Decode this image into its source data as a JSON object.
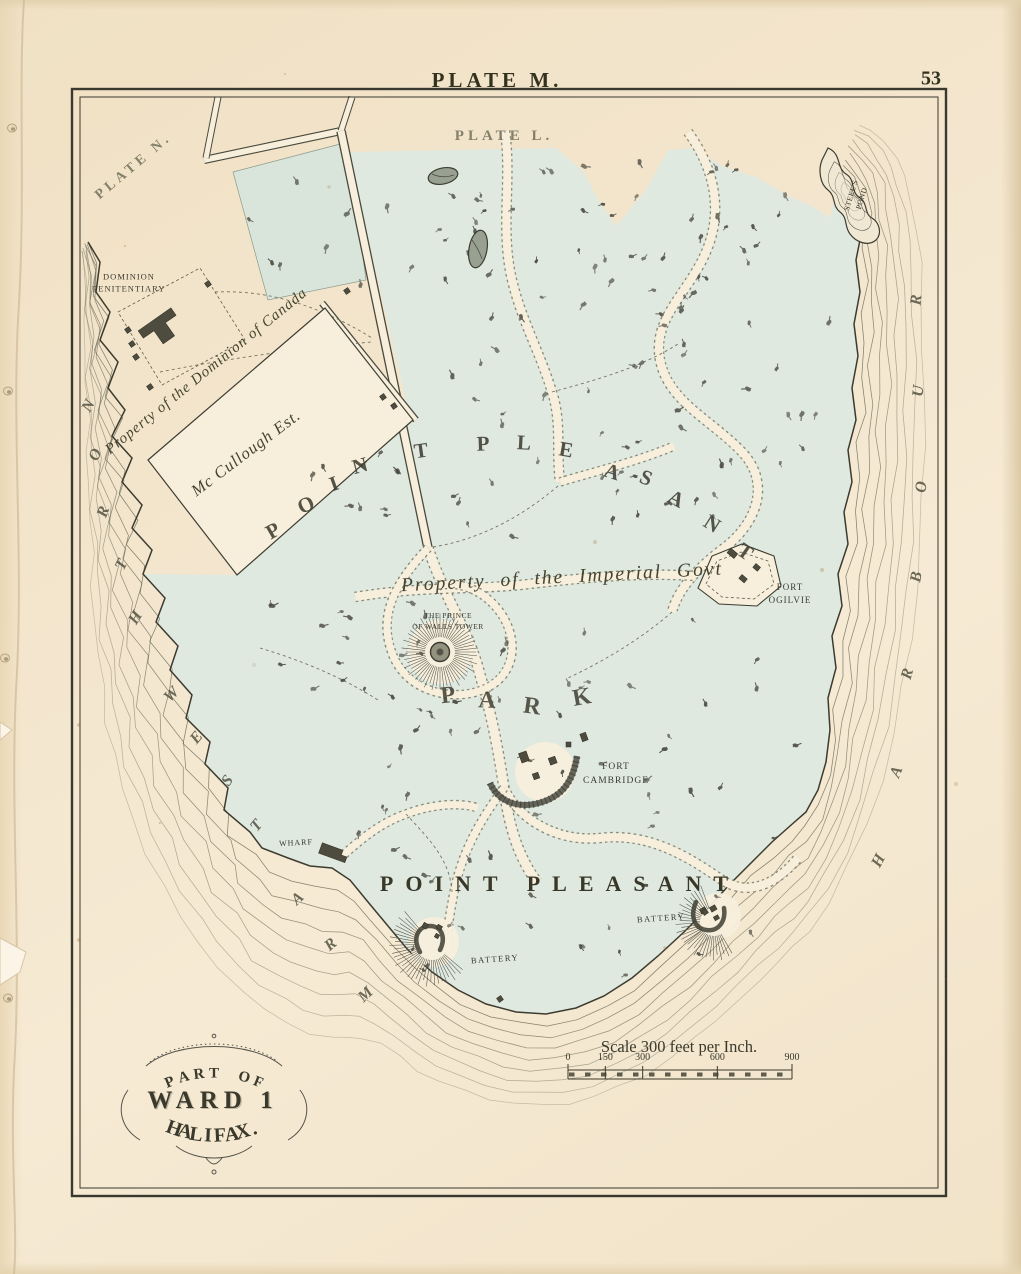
{
  "page": {
    "plate_title": "PLATE M.",
    "page_number": "53"
  },
  "map_labels": {
    "plate_l": "PLATE L.",
    "plate_n": "PLATE N.",
    "penitentiary_line1": "DOMINION",
    "penitentiary_line2": "PENITENTIARY",
    "property_dominion": "Property of the Dominion of Canada",
    "mccullough": "Mc Cullough Est.",
    "property_imperial": "Property of the Imperial Govt",
    "prince_line1": "THE PRINCE",
    "prince_line2": "OF WALES TOWER",
    "fort_ogilvie_line1": "FORT",
    "fort_ogilvie_line2": "OGILVIE",
    "fort_cambridge_line1": "FORT",
    "fort_cambridge_line2": "CAMBRIDGE",
    "wharf": "WHARF",
    "point_pleasant": "POINT PLEASANT",
    "battery_west": "BATTERY",
    "battery_east": "BATTERY",
    "steels_pond_line1": "STEEL'S",
    "steels_pond_line2": "POND"
  },
  "spread_letters": {
    "point_pleasant": [
      {
        "ch": "P",
        "x": 273,
        "y": 531,
        "r": -30
      },
      {
        "ch": "O",
        "x": 306,
        "y": 505,
        "r": -25
      },
      {
        "ch": "I",
        "x": 334,
        "y": 484,
        "r": -20
      },
      {
        "ch": "N",
        "x": 360,
        "y": 466,
        "r": -15
      },
      {
        "ch": "T",
        "x": 421,
        "y": 451,
        "r": -8
      },
      {
        "ch": "P",
        "x": 483,
        "y": 444,
        "r": -2
      },
      {
        "ch": "L",
        "x": 524,
        "y": 443,
        "r": 3
      },
      {
        "ch": "E",
        "x": 566,
        "y": 450,
        "r": 10
      },
      {
        "ch": "A",
        "x": 612,
        "y": 472,
        "r": 18
      },
      {
        "ch": "S",
        "x": 646,
        "y": 478,
        "r": 22
      },
      {
        "ch": "A",
        "x": 676,
        "y": 499,
        "r": 27
      },
      {
        "ch": "N",
        "x": 712,
        "y": 524,
        "r": 32
      },
      {
        "ch": "T",
        "x": 745,
        "y": 552,
        "r": 35
      }
    ],
    "park": [
      {
        "ch": "P",
        "x": 448,
        "y": 696,
        "r": -6
      },
      {
        "ch": "A",
        "x": 487,
        "y": 701,
        "r": 2
      },
      {
        "ch": "R",
        "x": 532,
        "y": 707,
        "r": 8
      },
      {
        "ch": "K",
        "x": 582,
        "y": 698,
        "r": -10
      }
    ],
    "north_west_arm": [
      {
        "ch": "N",
        "x": 89,
        "y": 406,
        "r": -62
      },
      {
        "ch": "O",
        "x": 96,
        "y": 455,
        "r": -66
      },
      {
        "ch": "R",
        "x": 104,
        "y": 512,
        "r": -70
      },
      {
        "ch": "T",
        "x": 122,
        "y": 565,
        "r": -64
      },
      {
        "ch": "H",
        "x": 136,
        "y": 618,
        "r": -58
      },
      {
        "ch": "W",
        "x": 172,
        "y": 695,
        "r": -46
      },
      {
        "ch": "E",
        "x": 197,
        "y": 738,
        "r": -50
      },
      {
        "ch": "S",
        "x": 228,
        "y": 781,
        "r": -54
      },
      {
        "ch": "T",
        "x": 257,
        "y": 826,
        "r": -50
      },
      {
        "ch": "A",
        "x": 298,
        "y": 899,
        "r": -44
      },
      {
        "ch": "R",
        "x": 331,
        "y": 945,
        "r": -40
      },
      {
        "ch": "M",
        "x": 366,
        "y": 995,
        "r": -44
      }
    ],
    "harbour": [
      {
        "ch": "H",
        "x": 879,
        "y": 861,
        "r": -62
      },
      {
        "ch": "A",
        "x": 897,
        "y": 772,
        "r": -68
      },
      {
        "ch": "R",
        "x": 908,
        "y": 674,
        "r": -74
      },
      {
        "ch": "B",
        "x": 917,
        "y": 577,
        "r": -80
      },
      {
        "ch": "O",
        "x": 922,
        "y": 487,
        "r": -86
      },
      {
        "ch": "U",
        "x": 919,
        "y": 391,
        "r": -85
      },
      {
        "ch": "R",
        "x": 917,
        "y": 300,
        "r": -85
      }
    ]
  },
  "scale_bar": {
    "title": "Scale 300 feet per Inch.",
    "tick_labels": [
      "0",
      "150",
      "300",
      "600",
      "900"
    ]
  },
  "cartouche": {
    "line1": "PART OF",
    "line2": "WARD 1",
    "line3": "HALIFAX."
  },
  "colors": {
    "paper": "#f3e5cc",
    "map_cream": "#f7efdc",
    "land_green": "#dfe9e0",
    "ink": "#3b3a2f",
    "water_line": "#6f6e5b",
    "building": "#4e4c3e"
  }
}
